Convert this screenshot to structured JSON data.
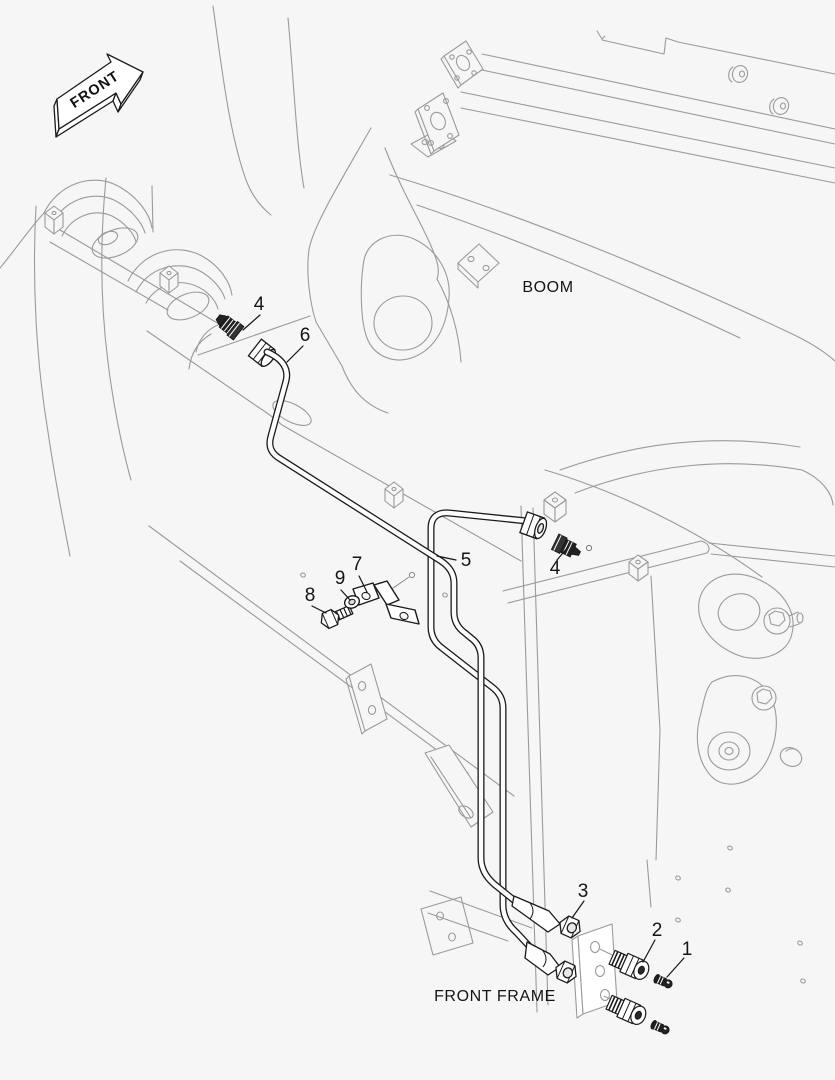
{
  "labels": {
    "front_arrow": "FRONT",
    "boom": "BOOM",
    "front_frame": "FRONT FRAME"
  },
  "callouts": [
    {
      "number": "4",
      "target": "grease-fitting-upper"
    },
    {
      "number": "6",
      "target": "grease-pipe-upper"
    },
    {
      "number": "5",
      "target": "grease-pipe-long"
    },
    {
      "number": "7",
      "target": "pipe-clamp"
    },
    {
      "number": "9",
      "target": "washer"
    },
    {
      "number": "8",
      "target": "bolt"
    },
    {
      "number": "4",
      "target": "grease-fitting-boom"
    },
    {
      "number": "3",
      "target": "pipe-nut"
    },
    {
      "number": "2",
      "target": "adapter-fitting"
    },
    {
      "number": "1",
      "target": "grease-nipple"
    }
  ],
  "colors": {
    "background": "#f6f6f6",
    "machine_line": "#9a9a9a",
    "part_line": "#1a1a1a",
    "text": "#141414"
  }
}
